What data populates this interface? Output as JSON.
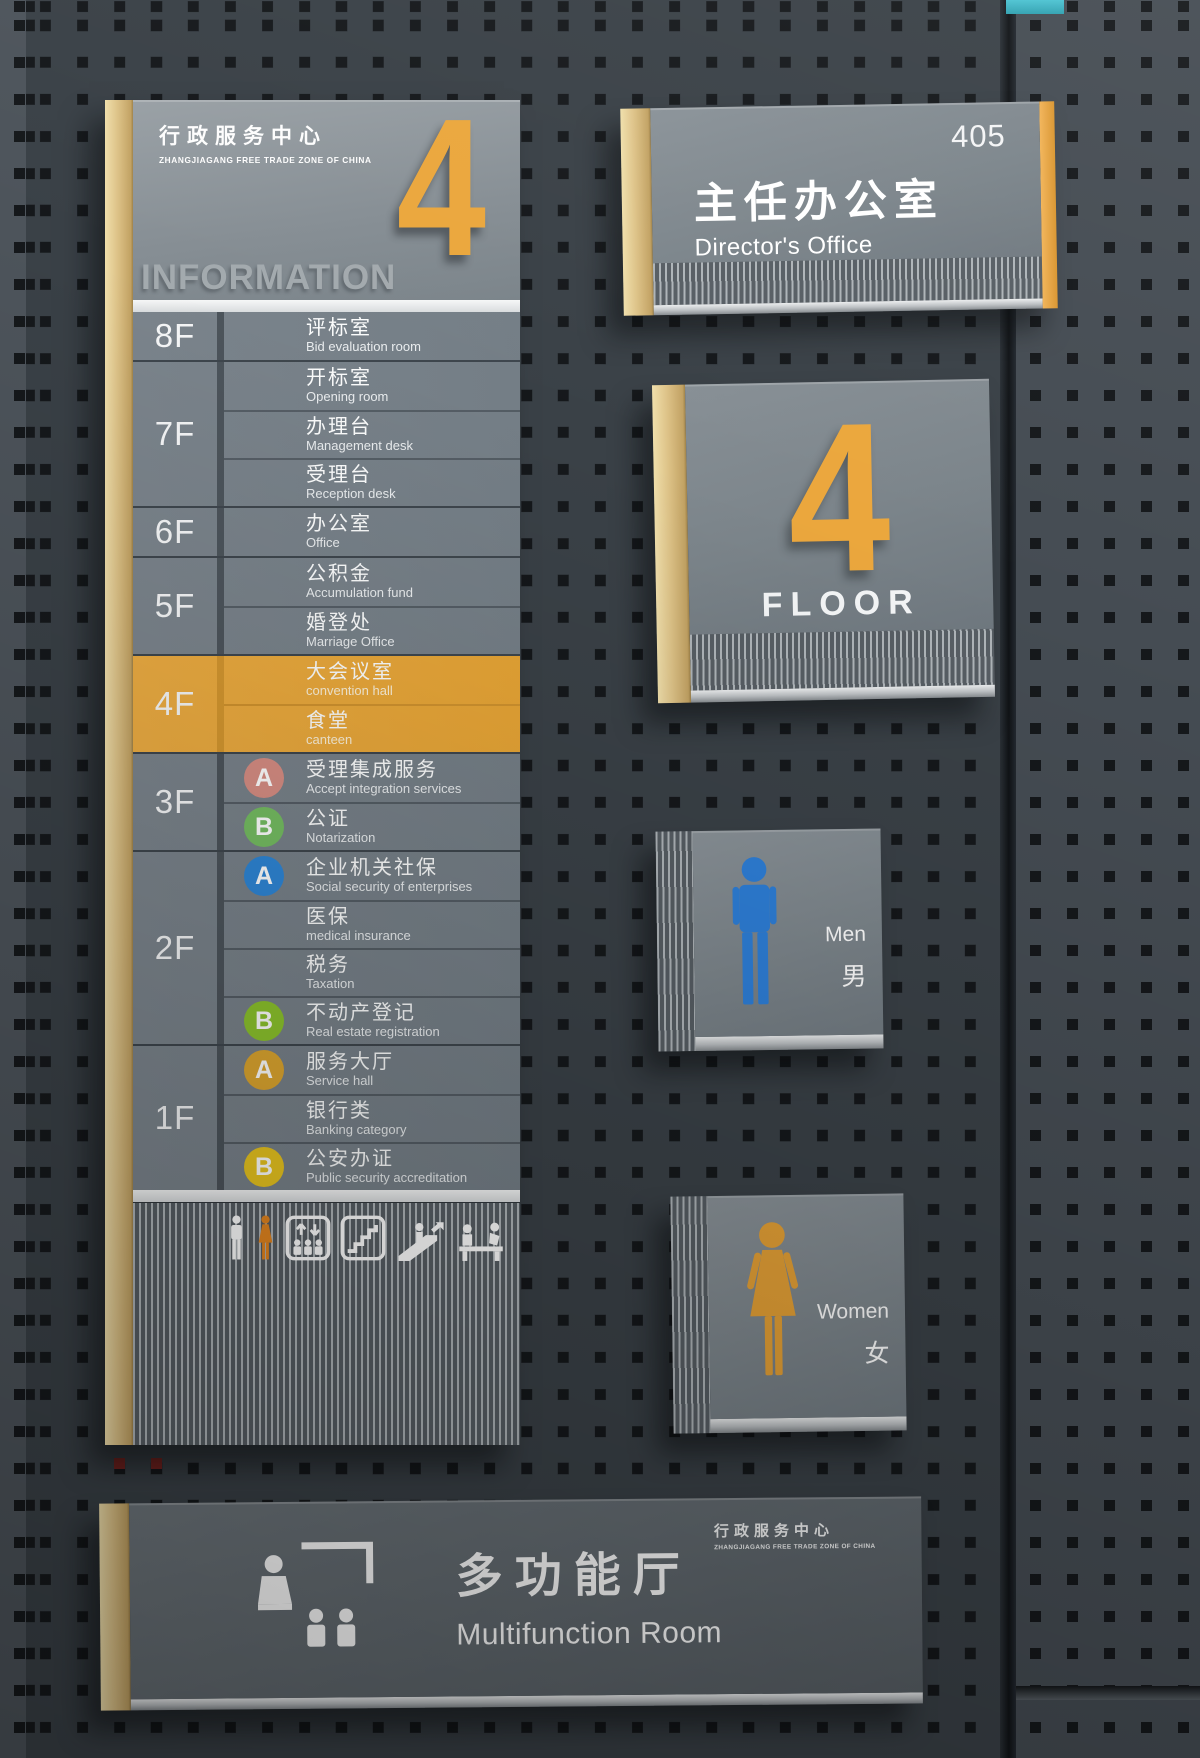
{
  "brand": {
    "title_cn": "行政服务中心",
    "subtitle_en": "ZHANGJIAGANG FREE TRADE ZONE OF CHINA"
  },
  "directory_sign": {
    "big_floor_number": "4",
    "heading": "INFORMATION",
    "groups": [
      {
        "floor": "8F",
        "highlight": false,
        "rooms": [
          {
            "cn": "评标室",
            "en": "Bid evaluation room"
          }
        ]
      },
      {
        "floor": "7F",
        "highlight": false,
        "rooms": [
          {
            "cn": "开标室",
            "en": "Opening room"
          },
          {
            "cn": "办理台",
            "en": "Management desk"
          },
          {
            "cn": "受理台",
            "en": "Reception desk"
          }
        ]
      },
      {
        "floor": "6F",
        "highlight": false,
        "rooms": [
          {
            "cn": "办公室",
            "en": "Office"
          }
        ]
      },
      {
        "floor": "5F",
        "highlight": false,
        "rooms": [
          {
            "cn": "公积金",
            "en": "Accumulation fund"
          },
          {
            "cn": "婚登处",
            "en": "Marriage Office"
          }
        ]
      },
      {
        "floor": "4F",
        "highlight": true,
        "rooms": [
          {
            "cn": "大会议室",
            "en": "convention hall"
          },
          {
            "cn": "食堂",
            "en": "canteen"
          }
        ]
      },
      {
        "floor": "3F",
        "highlight": false,
        "rooms": [
          {
            "cn": "受理集成服务",
            "en": "Accept integration services",
            "badge": "A",
            "badge_color": "#d68d83"
          },
          {
            "cn": "公证",
            "en": "Notarization",
            "badge": "B",
            "badge_color": "#75bd62"
          }
        ]
      },
      {
        "floor": "2F",
        "highlight": false,
        "rooms": [
          {
            "cn": "企业机关社保",
            "en": "Social security of enterprises",
            "badge": "A",
            "badge_color": "#2e86d6"
          },
          {
            "cn": "医保",
            "en": "medical insurance"
          },
          {
            "cn": "税务",
            "en": "Taxation"
          },
          {
            "cn": "不动产登记",
            "en": "Real estate registration",
            "badge": "B",
            "badge_color": "#8cc32c"
          }
        ]
      },
      {
        "floor": "1F",
        "highlight": false,
        "rooms": [
          {
            "cn": "服务大厅",
            "en": "Service hall",
            "badge": "A",
            "badge_color": "#dda62f"
          },
          {
            "cn": "银行类",
            "en": "Banking category"
          },
          {
            "cn": "公安办证",
            "en": "Public security accreditation",
            "badge": "B",
            "badge_color": "#e9c51f"
          }
        ]
      }
    ],
    "footer_icons": [
      "men-figure",
      "women-figure",
      "elevator",
      "stairs",
      "escalator",
      "service-counter"
    ]
  },
  "office_sign": {
    "room_number": "405",
    "title_cn": "主任办公室",
    "title_en": "Director's Office"
  },
  "floor_sign": {
    "number": "4",
    "label": "FLOOR"
  },
  "restroom_men": {
    "label_en": "Men",
    "label_cn": "男"
  },
  "restroom_women": {
    "label_en": "Women",
    "label_cn": "女"
  },
  "multifunction_sign": {
    "title_cn": "多功能厅",
    "title_en": "Multifunction Room",
    "brand_cn": "行政服务中心",
    "brand_en": "ZHANGJIAGANG FREE TRADE ZONE OF CHINA"
  },
  "colors": {
    "accent_orange": "#e9a83e",
    "wood_trim": "#ddc287",
    "men_blue": "#2e7fd8",
    "women_orange": "#e5a136",
    "wall": "#3a4147",
    "panel_gray": "#7d868c"
  }
}
